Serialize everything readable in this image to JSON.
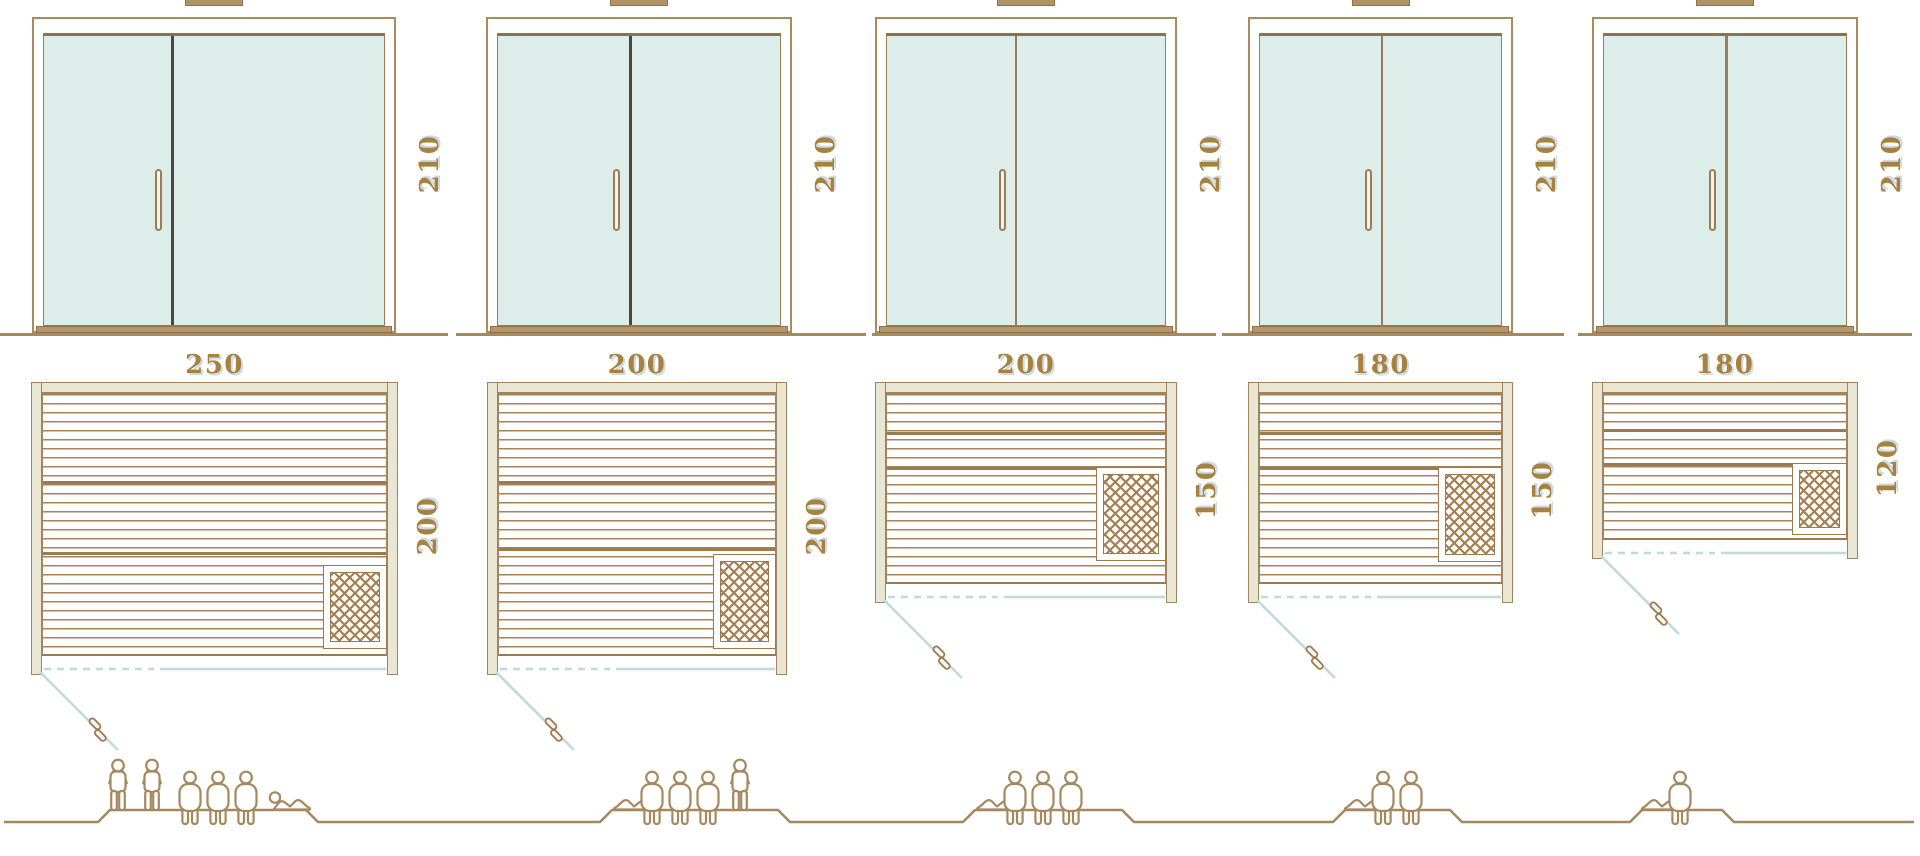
{
  "title": "Sauna cabin size comparison drawing",
  "colors": {
    "line_brown": "#a6885e",
    "frame_beige": "#e9e6d4",
    "glass_mint": "#dcedea",
    "teal_swing": "#bedbd7",
    "dimension_text": "#a7813e",
    "dark_divider": "#4c463e",
    "sill_tan": "#b2966c"
  },
  "sections": [
    {
      "front": {
        "height": "210"
      },
      "plan": {
        "width": "250",
        "depth": "200"
      },
      "capacity": {
        "count": 6,
        "figures": [
          "standing",
          "standing",
          "sitting",
          "sitting",
          "sitting",
          "lying"
        ]
      }
    },
    {
      "front": {
        "height": "210"
      },
      "plan": {
        "width": "200",
        "depth": "200"
      },
      "capacity": {
        "count": 5,
        "figures": [
          "lying",
          "sitting",
          "sitting",
          "sitting",
          "standing"
        ]
      }
    },
    {
      "front": {
        "height": "210"
      },
      "plan": {
        "width": "200",
        "depth": "150"
      },
      "capacity": {
        "count": 4,
        "figures": [
          "lying",
          "sitting",
          "sitting",
          "sitting"
        ]
      }
    },
    {
      "front": {
        "height": "210"
      },
      "plan": {
        "width": "180",
        "depth": "150"
      },
      "capacity": {
        "count": 3,
        "figures": [
          "lying",
          "sitting",
          "sitting"
        ]
      }
    },
    {
      "front": {
        "height": "210"
      },
      "plan": {
        "width": "180",
        "depth": "120"
      },
      "capacity": {
        "count": 2,
        "figures": [
          "lying",
          "sitting"
        ]
      }
    }
  ]
}
